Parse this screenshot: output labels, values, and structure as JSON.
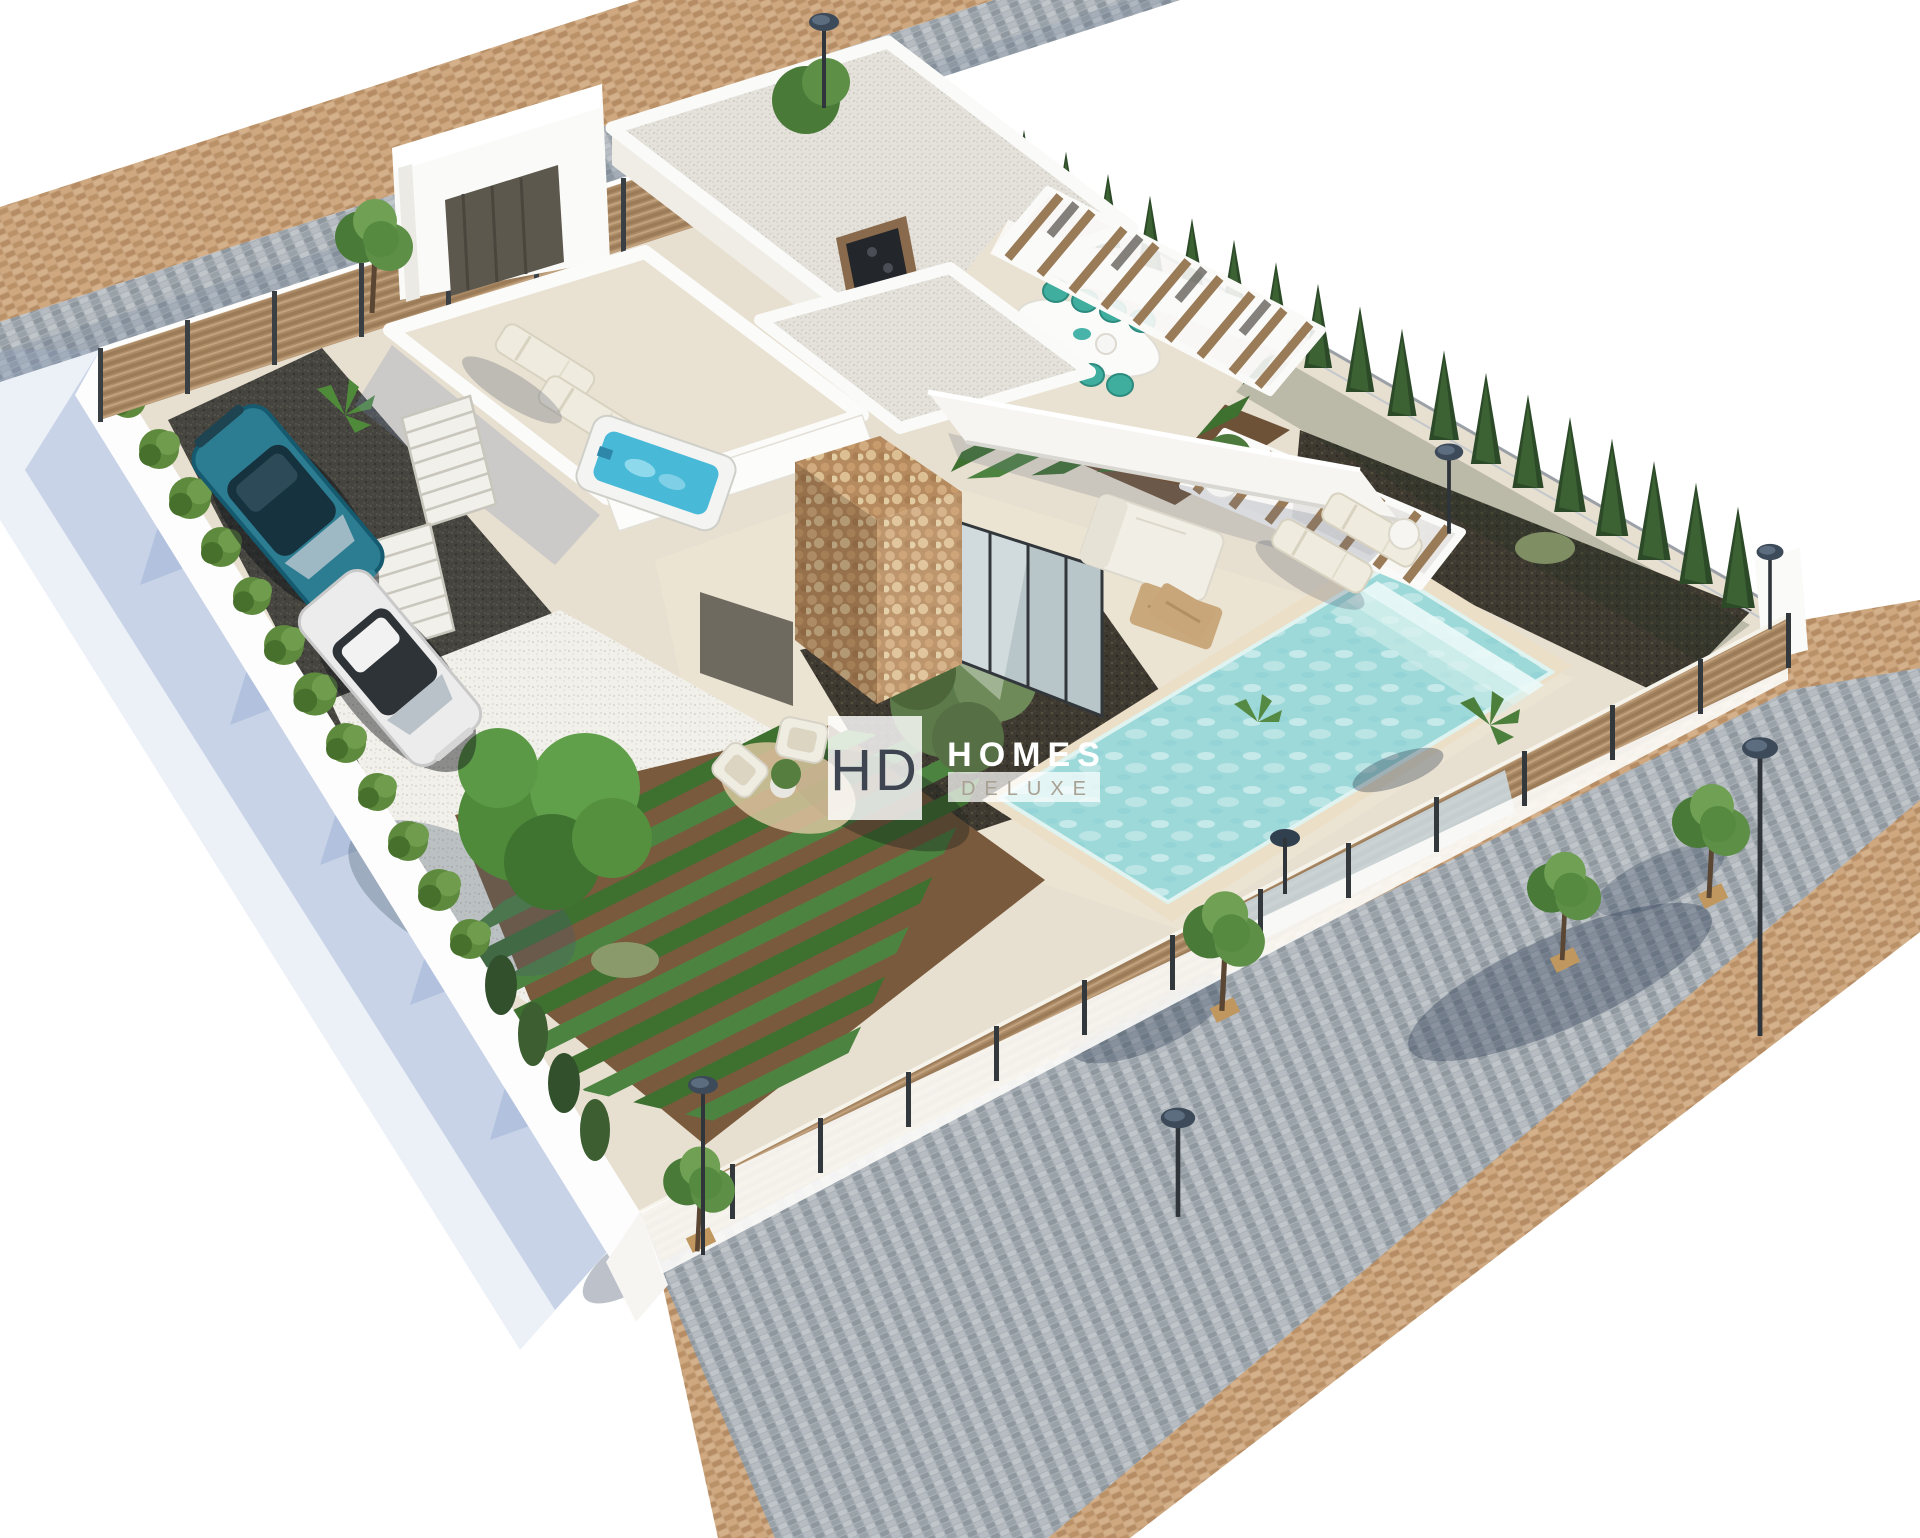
{
  "watermark": {
    "initials": "HD",
    "title": "HOMES",
    "subtitle": "DELUXE",
    "initials_color": "#3e4551",
    "title_color": "#ffffff",
    "subtitle_color": "#a8a193"
  },
  "palette": {
    "background": "#ffffff",
    "plot_travertine": "#e7dfcf",
    "deck_travertine": "#ece4d3",
    "pool_water": "#9ed9da",
    "pool_coping": "#ecdfc8",
    "hot_tub_water": "#49b9d8",
    "cypress_green": "#2c4a28",
    "hedge_green": "#5e8a3e",
    "wood_fence": "#ab8a66",
    "stone_wall": "#b58a5f",
    "road_pavers_tan": "#c9a47e",
    "road_cobbles_gray": "#aab1b7",
    "dark_gravel_driveway": "#45443f",
    "mulch_bed": "#3e3a31",
    "white_gravel": "#f2f0ea",
    "car_teal": "#2c7d92",
    "car_white": "#ececec",
    "dining_chair_teal": "#3fae9f",
    "shadow_blue": "rgba(151,172,210,0.42)"
  },
  "scene": {
    "description": "Aerial isometric 3D render of a modern villa plot with pool, rooftop terrace, gardens and surrounding streets",
    "counts": {
      "cars": 2,
      "rooftop_loungers": 2,
      "pool_loungers": 2,
      "dining_chairs": 8,
      "street_lamps": 6
    },
    "elements": [
      "villa-house",
      "flat-gravel-roofs",
      "rooftop-terrace",
      "hot-tub",
      "rooftop-loungers",
      "exterior-stairs",
      "outdoor-dining-table",
      "dining-chairs",
      "bbq-counter",
      "pergola-slats",
      "stone-feature-column",
      "glass-sliding-doors",
      "outdoor-sofa-set",
      "coffee-table",
      "armchair-nook",
      "jute-rug",
      "swimming-pool",
      "pool-steps",
      "pool-loungers",
      "pool-side-table",
      "vegetable-garden-rows",
      "olive-tree-on-mulch",
      "garden-tree",
      "white-gravel-bed",
      "ornamental-grass",
      "dark-gravel-driveway",
      "teal-car",
      "white-car",
      "privacy-hedge",
      "cypress-tree-row",
      "wood-slat-fence",
      "glass-fence-panels",
      "entrance-gate",
      "perimeter-wall",
      "cobblestone-road",
      "tan-paver-sidewalks",
      "street-lamps",
      "street-trees",
      "tree-shadows",
      "watermark-logo"
    ]
  }
}
